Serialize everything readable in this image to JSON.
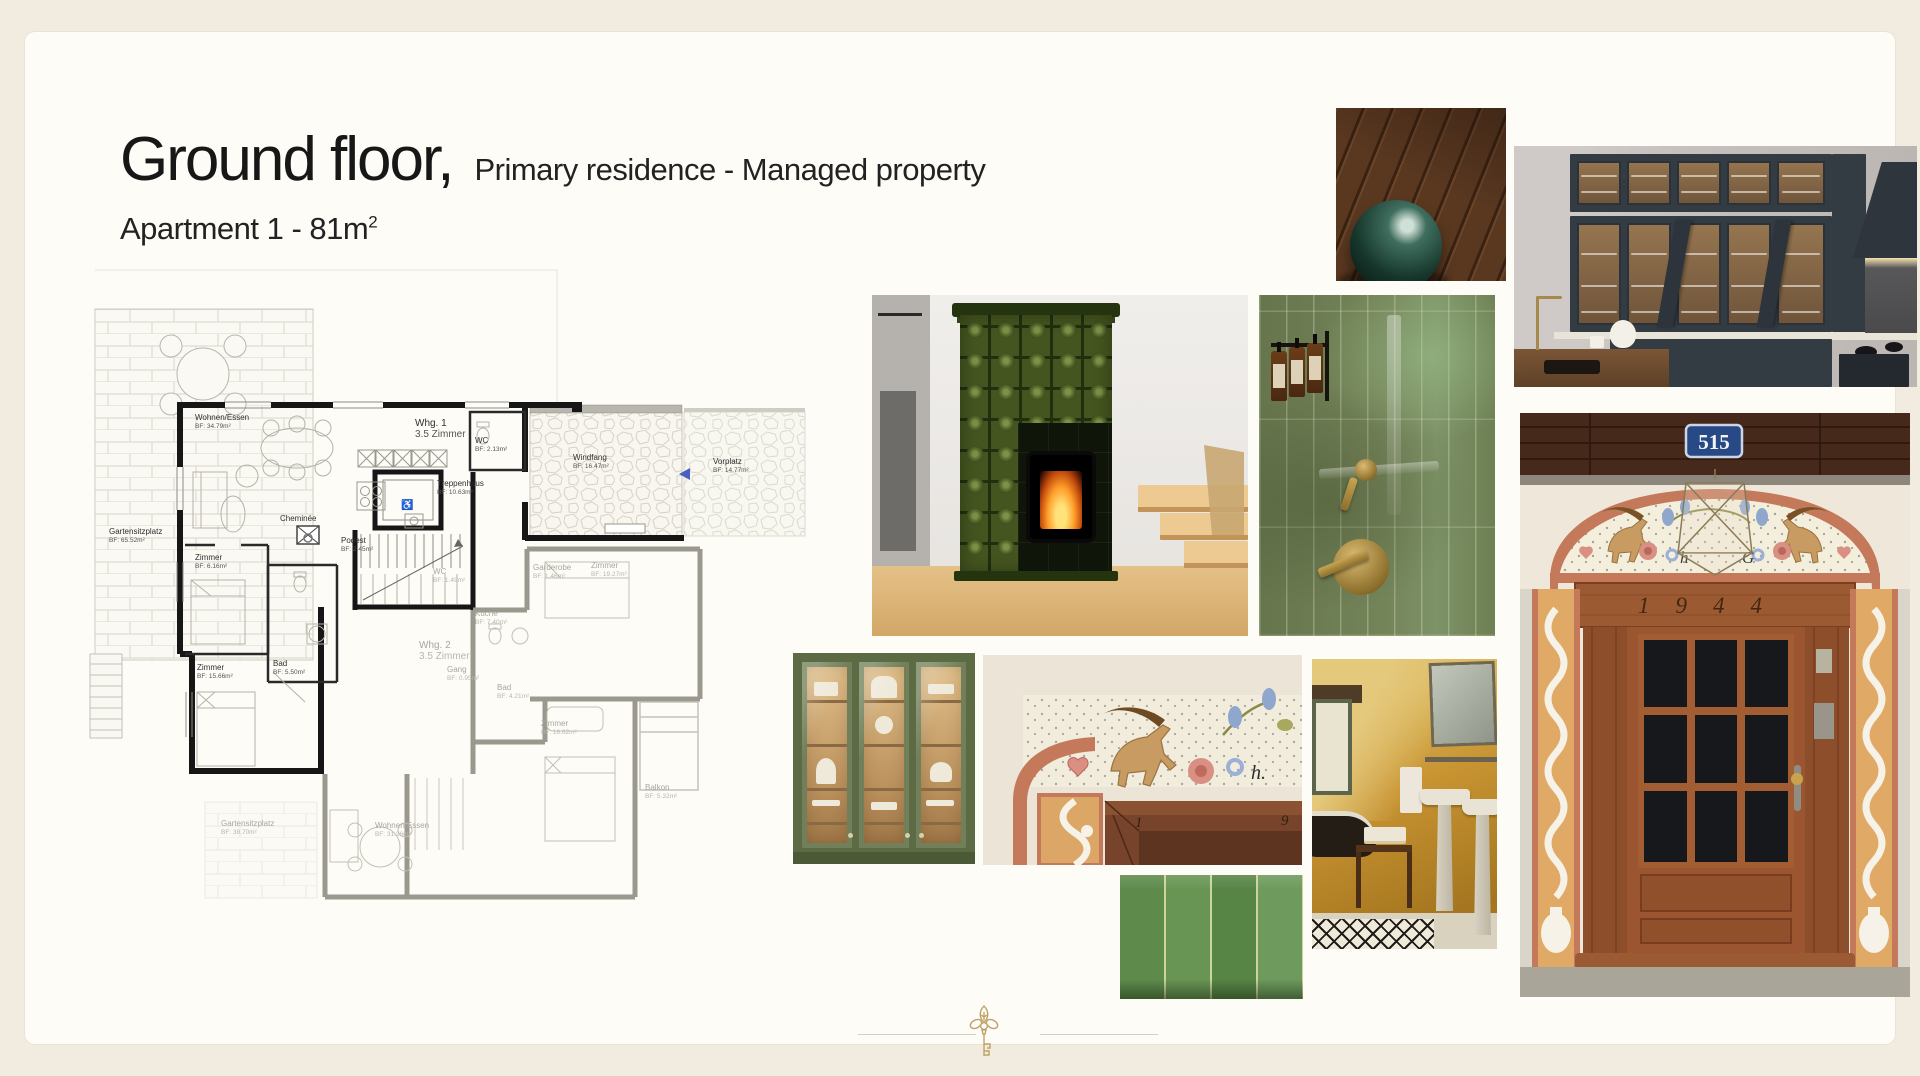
{
  "header": {
    "title": "Ground floor,",
    "suffix": "Primary residence - Managed property",
    "subtitle": "Apartment 1 - 81m",
    "subtitle_sup": "2"
  },
  "floor_plan": {
    "wheelchair": "♿",
    "labels": [
      {
        "n": "Gartensitzplatz",
        "a": "BF: 65.52m²",
        "x": 34,
        "y": 272,
        "c": "d"
      },
      {
        "n": "Wohnen/Essen",
        "a": "BF: 34.79m²",
        "x": 120,
        "y": 158,
        "c": "d"
      },
      {
        "n": "Whg. 1",
        "a": "3.5 Zimmer",
        "x": 340,
        "y": 164,
        "c": "d",
        "s": 2
      },
      {
        "n": "WC",
        "a": "BF: 2.13m²",
        "x": 400,
        "y": 181,
        "c": "d"
      },
      {
        "n": "Windfang",
        "a": "BF: 16.47m²",
        "x": 498,
        "y": 198,
        "c": "d"
      },
      {
        "n": "Vorplatz",
        "a": "BF: 14.77m²",
        "x": 638,
        "y": 202,
        "c": "d"
      },
      {
        "n": "Treppenhaus",
        "a": "BF: 10.63m²",
        "x": 362,
        "y": 224,
        "c": "d"
      },
      {
        "n": "Cheminée",
        "a": "",
        "x": 205,
        "y": 259,
        "c": "d"
      },
      {
        "n": "Podest",
        "a": "BF: 2.45m²",
        "x": 266,
        "y": 281,
        "c": "d"
      },
      {
        "n": "Zimmer",
        "a": "BF: 6.16m²",
        "x": 120,
        "y": 298,
        "c": "d"
      },
      {
        "n": "Bad",
        "a": "BF: 5.50m²",
        "x": 198,
        "y": 404,
        "c": "d"
      },
      {
        "n": "Zimmer",
        "a": "BF: 15.66m²",
        "x": 122,
        "y": 408,
        "c": "d"
      },
      {
        "n": "WC",
        "a": "BF: 1.49m²",
        "x": 358,
        "y": 312,
        "c": "g"
      },
      {
        "n": "Garderobe",
        "a": "BF: 1.46m²",
        "x": 458,
        "y": 308,
        "c": "g"
      },
      {
        "n": "Küche",
        "a": "BF: 7.40m²",
        "x": 400,
        "y": 354,
        "c": "g"
      },
      {
        "n": "Whg. 2",
        "a": "3.5 Zimmer",
        "x": 344,
        "y": 386,
        "c": "g",
        "s": 2
      },
      {
        "n": "Gang",
        "a": "BF: 0.95m²",
        "x": 372,
        "y": 410,
        "c": "g"
      },
      {
        "n": "Bad",
        "a": "BF: 4.21m²",
        "x": 422,
        "y": 428,
        "c": "g"
      },
      {
        "n": "Zimmer",
        "a": "BF: 19.27m²",
        "x": 516,
        "y": 306,
        "c": "g"
      },
      {
        "n": "Zimmer",
        "a": "BF: 16.62m²",
        "x": 466,
        "y": 464,
        "c": "g"
      },
      {
        "n": "Wohnen/Essen",
        "a": "BF: 31.36m²",
        "x": 300,
        "y": 566,
        "c": "g"
      },
      {
        "n": "Balkon",
        "a": "BF: 5.32m²",
        "x": 570,
        "y": 528,
        "c": "g"
      },
      {
        "n": "Gartensitzplatz",
        "a": "BF: 38.70m²",
        "x": 146,
        "y": 564,
        "c": "g"
      }
    ]
  },
  "mood_board": {
    "images": [
      "wood-floor-with-glass-sphere",
      "dark-blue-kitchen-with-glass-cabinets",
      "green-tiled-stove-fireplace",
      "green-shower-tiles-with-brass-fixtures",
      "painted-entrance-door-515",
      "sage-green-display-cabinet",
      "painted-door-frame-fresco-detail",
      "ochre-attic-bathroom",
      "green-glazed-tiles-closeup"
    ],
    "door": {
      "house_number": "515",
      "year": "1944",
      "initial_left": "h",
      "initial_right": "G"
    },
    "detail": {
      "digit_left": "1",
      "digit_right": "9",
      "initial": "h."
    }
  },
  "palette": {
    "page_cream": "#f1ecdf",
    "card": "#fdfcf7",
    "stove_green": "#45551f",
    "shower_green": "#75855a",
    "tile_green": "#5e8a4c",
    "kitchen_navy": "#333b43",
    "ochre": "#c89432",
    "terracotta": "#c3795a",
    "door_wood": "#9b5631",
    "brass": "#b08d3f",
    "plan_accent_blue": "#4a5fc0",
    "key_gold": "#bfa267"
  }
}
